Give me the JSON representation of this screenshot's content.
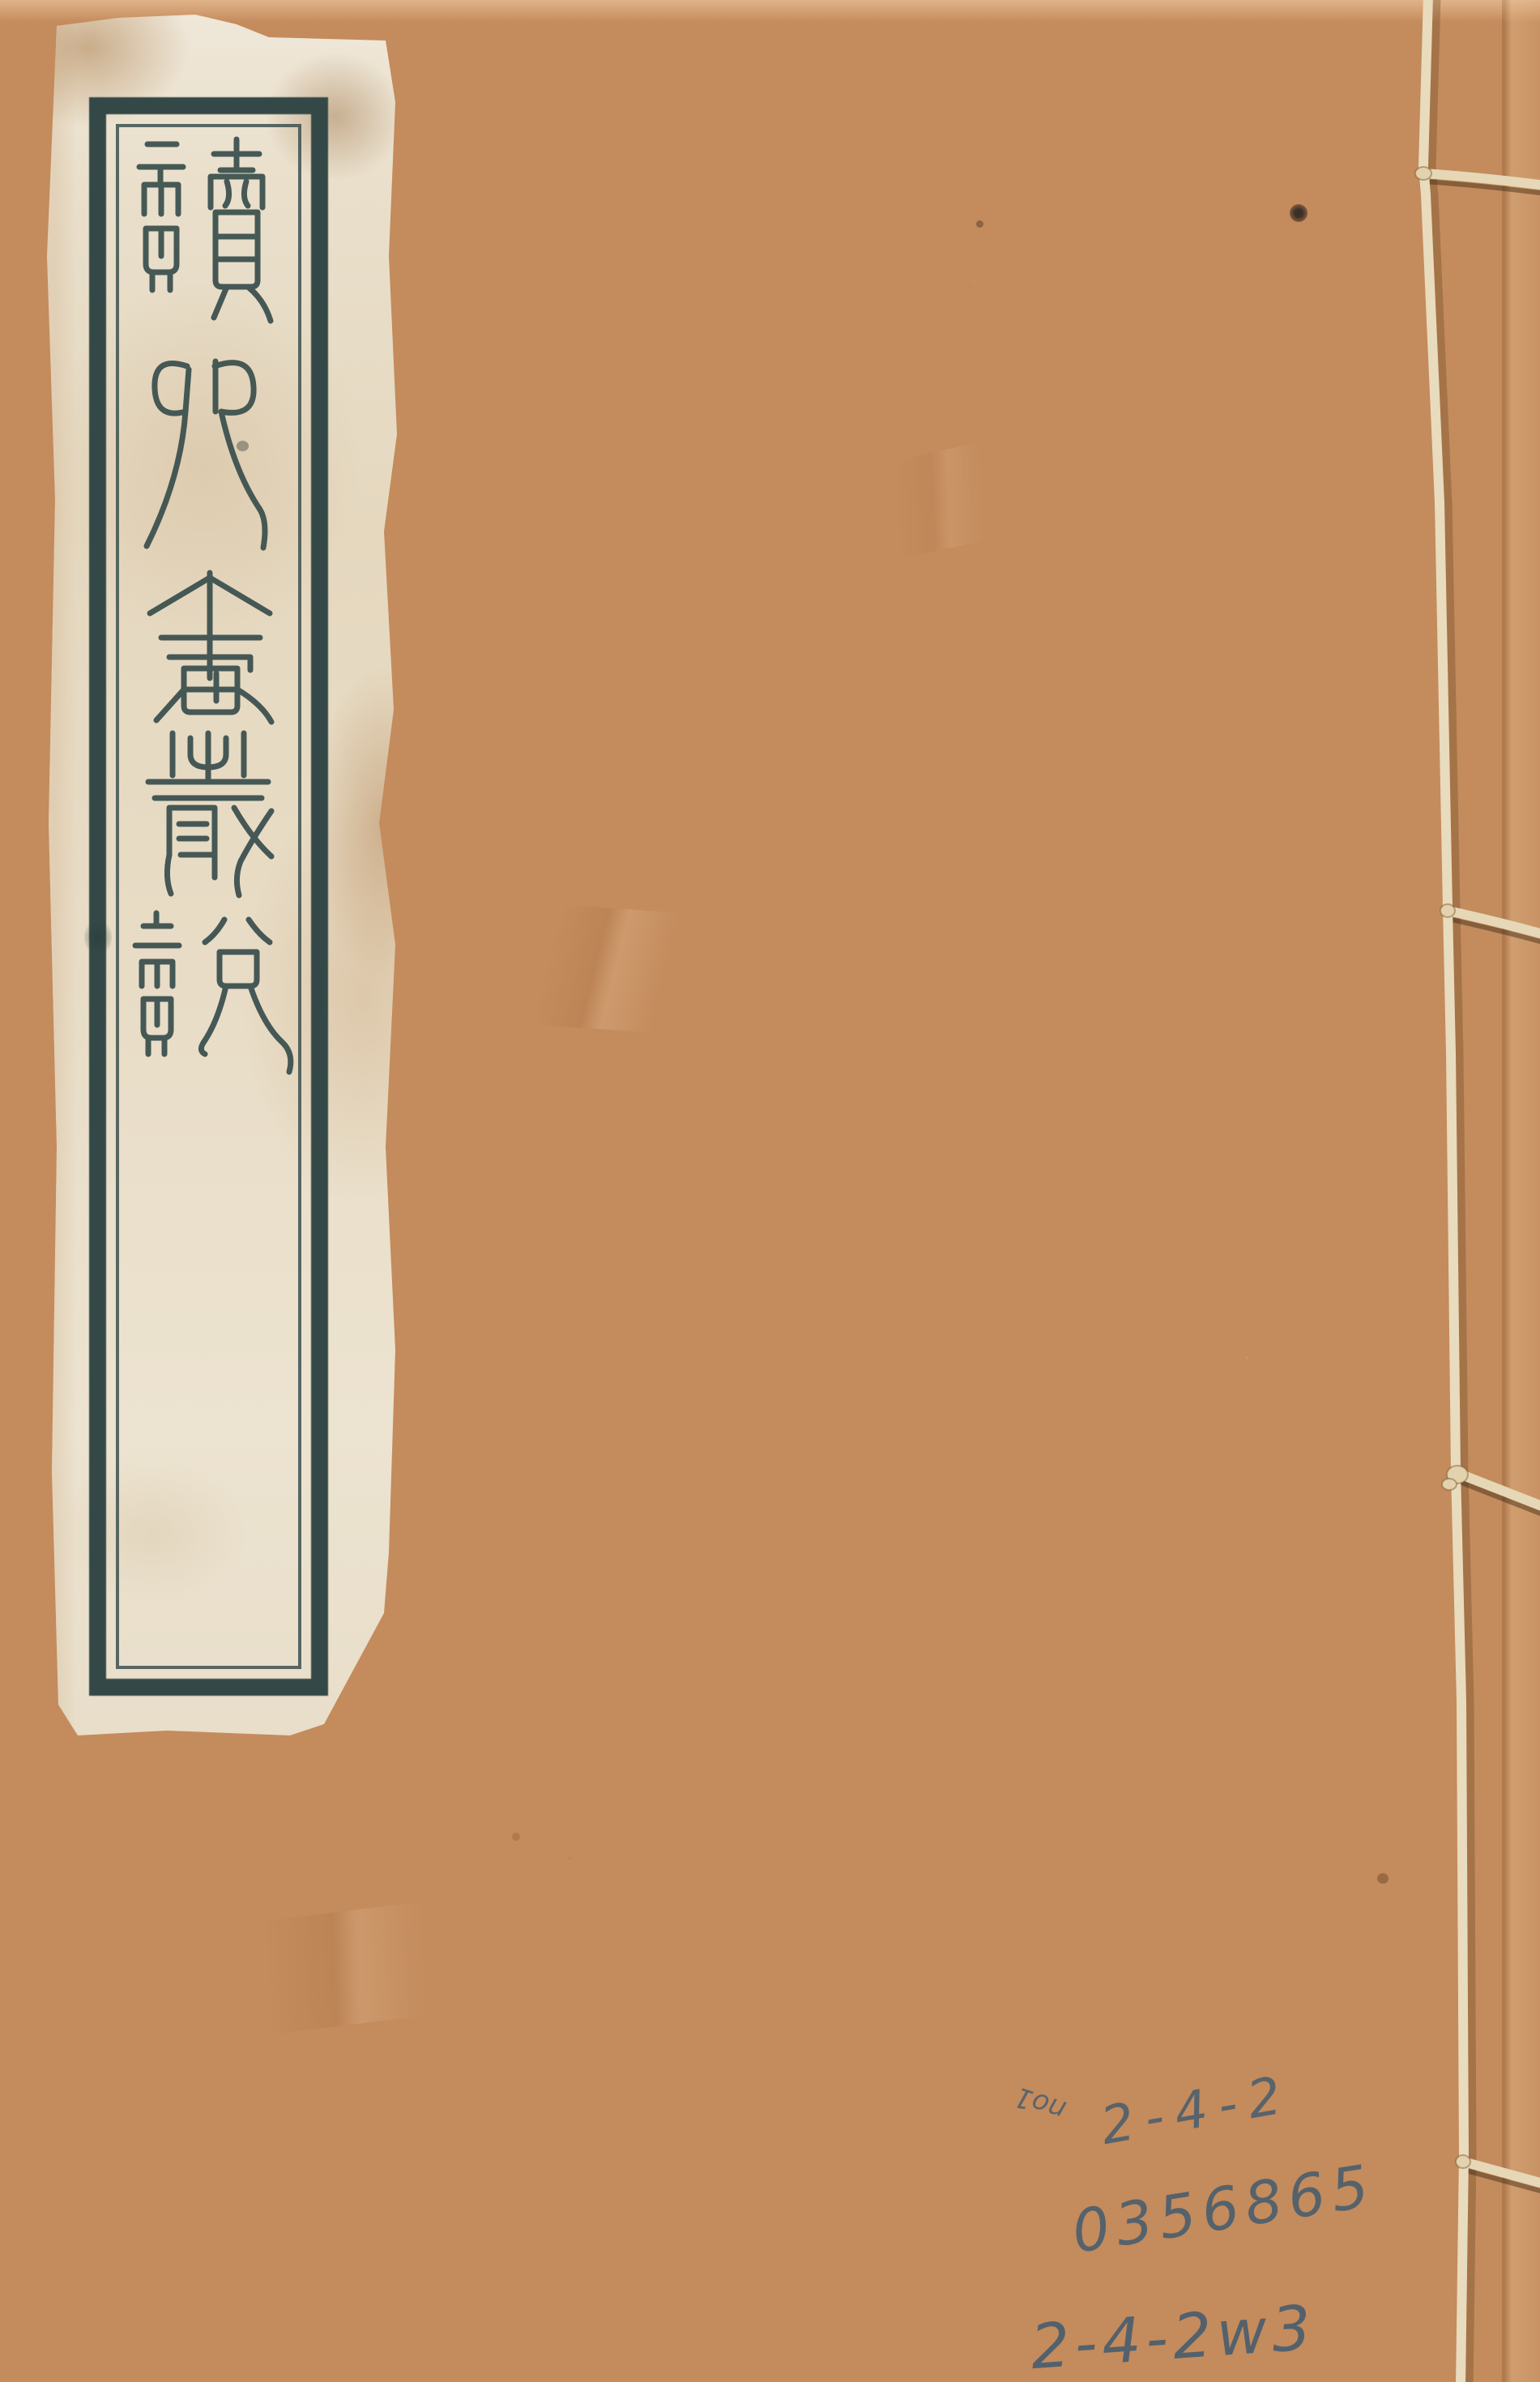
{
  "page": {
    "description": "Scanned front cover of a Chinese thread-bound book (xianzhuangshu) with a seal-script title label pasted at upper left and handwritten library numbers at lower right",
    "cover_color": "#c48b5c"
  },
  "title_label": {
    "title": "讀四書叢說",
    "characters": [
      "讀",
      "四",
      "書",
      "叢",
      "說"
    ],
    "script": "seal script, vertical top-to-bottom",
    "frame_color": "#344947",
    "paper_color": "#e9dfc9"
  },
  "binding": {
    "style": "four-hole stab stitch thread binding",
    "thread_color": "#e8dabb",
    "stitch_points": 4
  },
  "annotations": {
    "corner_mark": "no1",
    "line1": "2-4-2",
    "line2": "0356865",
    "line3": "2-4-2w3",
    "ink_color": "#4a5e6e"
  }
}
